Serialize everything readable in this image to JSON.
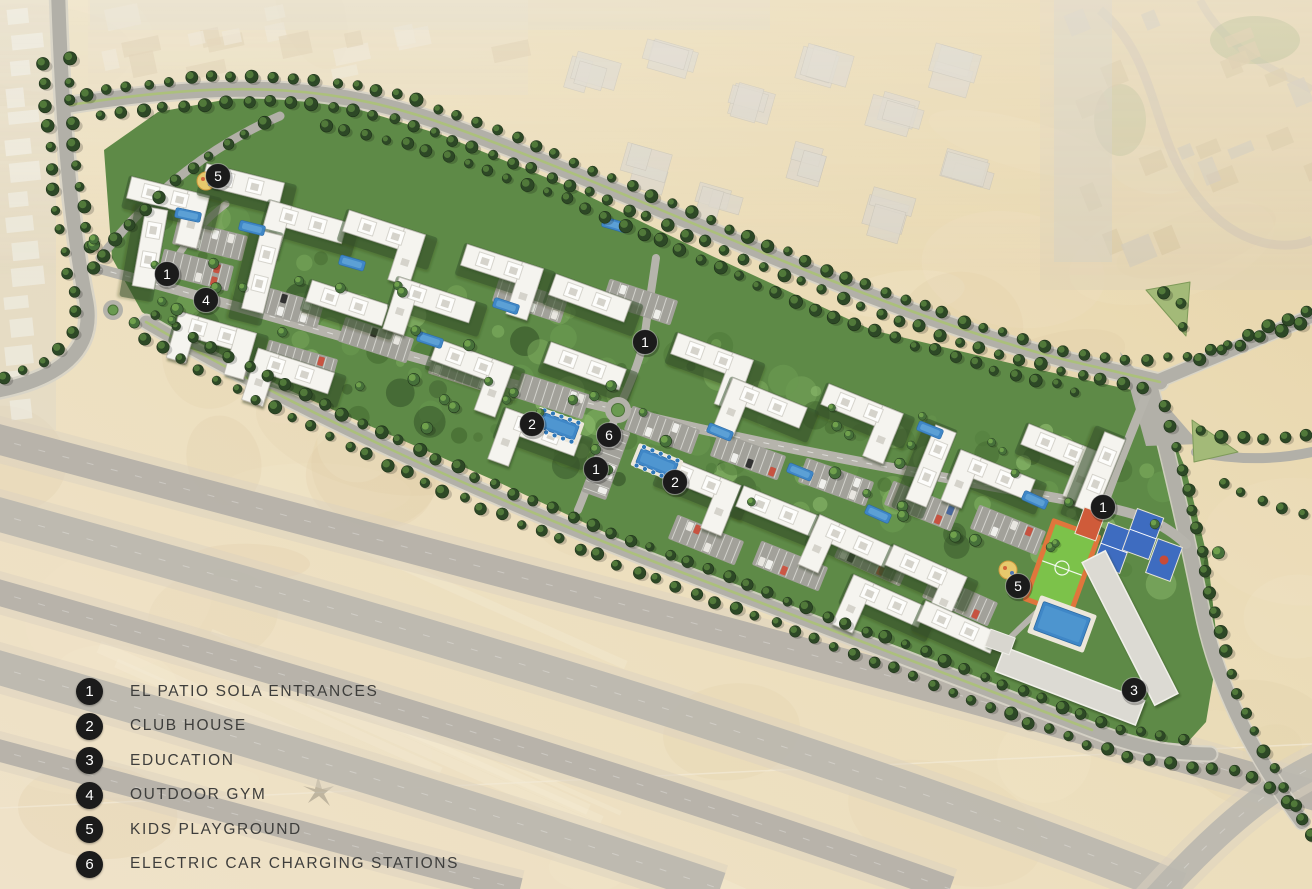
{
  "legend": {
    "items": [
      {
        "number": "1",
        "label": "EL PATIO SOLA ENTRANCES"
      },
      {
        "number": "2",
        "label": "CLUB HOUSE"
      },
      {
        "number": "3",
        "label": "EDUCATION"
      },
      {
        "number": "4",
        "label": "OUTDOOR GYM"
      },
      {
        "number": "5",
        "label": "KIDS PLAYGROUND"
      },
      {
        "number": "6",
        "label": "ELECTRIC CAR CHARGING STATIONS"
      }
    ]
  },
  "markers": [
    {
      "number": "5",
      "x": 218,
      "y": 176,
      "meaning": "KIDS PLAYGROUND"
    },
    {
      "number": "1",
      "x": 167,
      "y": 274,
      "meaning": "EL PATIO SOLA ENTRANCES"
    },
    {
      "number": "4",
      "x": 206,
      "y": 300,
      "meaning": "OUTDOOR GYM"
    },
    {
      "number": "1",
      "x": 645,
      "y": 342,
      "meaning": "EL PATIO SOLA ENTRANCES"
    },
    {
      "number": "2",
      "x": 532,
      "y": 424,
      "meaning": "CLUB HOUSE"
    },
    {
      "number": "6",
      "x": 609,
      "y": 435,
      "meaning": "ELECTRIC CAR CHARGING STATIONS"
    },
    {
      "number": "1",
      "x": 596,
      "y": 469,
      "meaning": "EL PATIO SOLA ENTRANCES"
    },
    {
      "number": "2",
      "x": 675,
      "y": 482,
      "meaning": "CLUB HOUSE"
    },
    {
      "number": "1",
      "x": 1103,
      "y": 507,
      "meaning": "EL PATIO SOLA ENTRANCES"
    },
    {
      "number": "5",
      "x": 1018,
      "y": 586,
      "meaning": "KIDS PLAYGROUND"
    },
    {
      "number": "3",
      "x": 1134,
      "y": 690,
      "meaning": "EDUCATION"
    }
  ],
  "colors": {
    "marker_bg": "#1b1b1b",
    "marker_text": "#ffffff",
    "legend_text": "#3e3e3c",
    "sand": "#e9dbba",
    "development_green": "#5e8a47",
    "road_gray": "#b2b0a8",
    "building_white": "#f5f4ef",
    "pool_blue": "#3f87c7",
    "court_green": "#7cc24a",
    "court_blue": "#3e6cc0",
    "court_border_orange": "#e0763c"
  }
}
